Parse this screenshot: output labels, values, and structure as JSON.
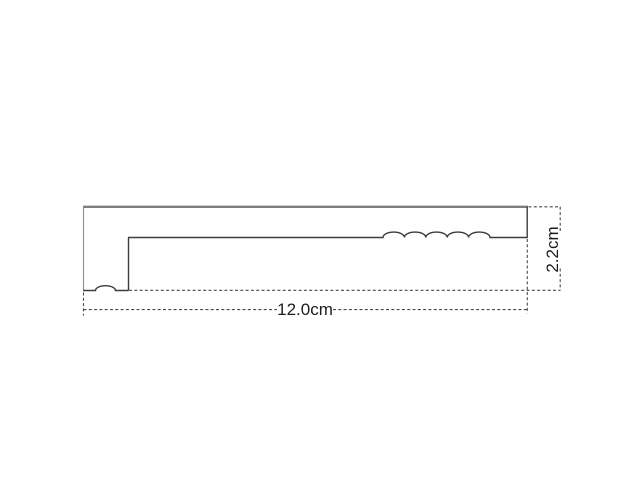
{
  "drawing": {
    "title": "profile-cross-section-technical-drawing",
    "dimensions": {
      "width_label": "12.0cm",
      "height_label": "2.2cm"
    },
    "shape": {
      "inner_line_bump_count": 5,
      "bottom_left_bump_count": 1
    },
    "colors": {
      "background": "#ffffff",
      "outline": "#3c3c3c",
      "outline_top": "#7d7d7d",
      "outline_left": "#8e8e8e",
      "dashed_line": "#4a4a4a",
      "text": "#1c1c1c"
    }
  }
}
